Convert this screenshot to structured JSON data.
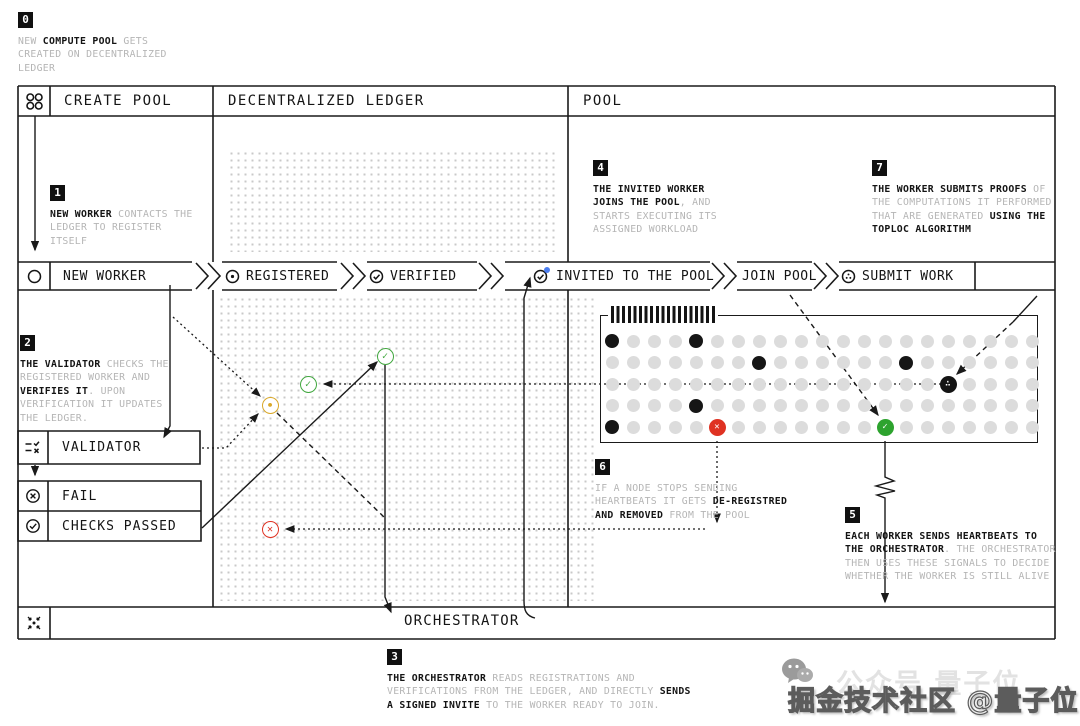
{
  "header": {
    "cells": [
      {
        "label": "CREATE POOL"
      },
      {
        "label": "DECENTRALIZED LEDGER"
      },
      {
        "label": "POOL"
      }
    ]
  },
  "band": {
    "steps": [
      {
        "icon": "worker-circle-icon",
        "label": "NEW WORKER"
      },
      {
        "icon": "registered-dot-circle-icon",
        "label": "REGISTERED"
      },
      {
        "icon": "verified-check-circle-icon",
        "label": "VERIFIED"
      },
      {
        "icon": "invited-check-circle-icon",
        "label": "INVITED TO THE POOL"
      },
      {
        "icon": null,
        "label": "JOIN POOL"
      },
      {
        "icon": "submit-work-circle-icon",
        "label": "SUBMIT WORK"
      }
    ]
  },
  "boxes": {
    "validator": "VALIDATOR",
    "fail": "FAIL",
    "checks_passed": "CHECKS PASSED",
    "orchestrator": "ORCHESTRATOR"
  },
  "annotations": {
    "step0": {
      "badge": "0",
      "segments": [
        {
          "t": "NEW ",
          "d": 0
        },
        {
          "t": "COMPUTE POOL",
          "d": 1
        },
        {
          "t": " GETS\nCREATED ON DECENTRALIZED\nLEDGER",
          "d": 0
        }
      ]
    },
    "step1": {
      "badge": "1",
      "segments": [
        {
          "t": "NEW WORKER",
          "d": 1
        },
        {
          "t": " CONTACTS THE\nLEDGER TO REGISTER\nITSELF",
          "d": 0
        }
      ]
    },
    "step2": {
      "badge": "2",
      "segments": [
        {
          "t": "THE VALIDATOR",
          "d": 1
        },
        {
          "t": " CHECKS THE\nREGISTERED WORKER AND\n",
          "d": 0
        },
        {
          "t": "VERIFIES IT",
          "d": 1
        },
        {
          "t": ". UPON\nVERIFICATION IT UPDATES\nTHE LEDGER.",
          "d": 0
        }
      ]
    },
    "step3": {
      "badge": "3",
      "segments": [
        {
          "t": "THE ORCHESTRATOR",
          "d": 1
        },
        {
          "t": " READS REGISTRATIONS AND\nVERIFICATIONS FROM THE LEDGER, AND DIRECTLY ",
          "d": 0
        },
        {
          "t": "SENDS\nA SIGNED INVITE",
          "d": 1
        },
        {
          "t": " TO THE WORKER READY TO JOIN.",
          "d": 0
        }
      ]
    },
    "step4": {
      "badge": "4",
      "segments": [
        {
          "t": "THE INVITED WORKER\nJOINS THE POOL",
          "d": 1
        },
        {
          "t": ", AND\nSTARTS EXECUTING ITS\nASSIGNED WORKLOAD",
          "d": 0
        }
      ]
    },
    "step5": {
      "badge": "5",
      "segments": [
        {
          "t": "EACH WORKER SENDS HEARTBEATS TO\nTHE ORCHESTRATOR",
          "d": 1
        },
        {
          "t": ". THE ORCHESTRATOR\nTHEN USES THESE SIGNALS TO DECIDE\nWHETHER THE WORKER IS STILL ALIVE",
          "d": 0
        }
      ]
    },
    "step6": {
      "badge": "6",
      "segments": [
        {
          "t": "IF A NODE STOPS SENDING\nHEARTBEATS IT GETS ",
          "d": 0
        },
        {
          "t": "DE-REGISTRED\nAND REMOVED",
          "d": 1
        },
        {
          "t": " FROM THE POOL",
          "d": 0
        }
      ]
    },
    "step7": {
      "badge": "7",
      "segments": [
        {
          "t": "THE WORKER SUBMITS PROOFS",
          "d": 1
        },
        {
          "t": " OF\nTHE COMPUTATIONS IT PERFORMED\nTHAT ARE GENERATED ",
          "d": 0
        },
        {
          "t": "USING THE\nTOPLOC ALGORITHM",
          "d": 1
        }
      ]
    }
  },
  "ledger": {
    "marks": [
      {
        "name": "check-pending-mark",
        "x": 270,
        "y": 405,
        "color": "#d9a82a",
        "glyph": "•"
      },
      {
        "name": "verified-mark",
        "x": 308,
        "y": 384,
        "color": "#41a73f",
        "glyph": "✓"
      },
      {
        "name": "verified-mark",
        "x": 385,
        "y": 356,
        "color": "#41a73f",
        "glyph": "✓"
      },
      {
        "name": "failed-mark",
        "x": 270,
        "y": 529,
        "color": "#df3222",
        "glyph": "✕"
      }
    ]
  },
  "pool": {
    "grid": {
      "rows": 5,
      "cols": 21,
      "origin_x": 612,
      "origin_y": 341,
      "dx": 21,
      "dy": 21.5,
      "idle_color": "#dcdcdc",
      "active_color": "#161616",
      "black_nodes": [
        [
          0,
          0
        ],
        [
          0,
          4
        ],
        [
          1,
          7
        ],
        [
          1,
          14
        ],
        [
          3,
          4
        ],
        [
          4,
          0
        ]
      ],
      "status_nodes": [
        {
          "r": 2,
          "c": 16,
          "kind": "submitting-work-node",
          "bg": "#141414",
          "glyph": "∴"
        },
        {
          "r": 4,
          "c": 5,
          "kind": "de-registered-node",
          "bg": "#df3222",
          "glyph": "✕"
        },
        {
          "r": 4,
          "c": 13,
          "kind": "alive-node",
          "bg": "#2da32e",
          "glyph": "✓"
        }
      ]
    }
  },
  "watermark": {
    "main": "掘金技术社区 @量子位",
    "ghost": "公众号 量子位"
  }
}
